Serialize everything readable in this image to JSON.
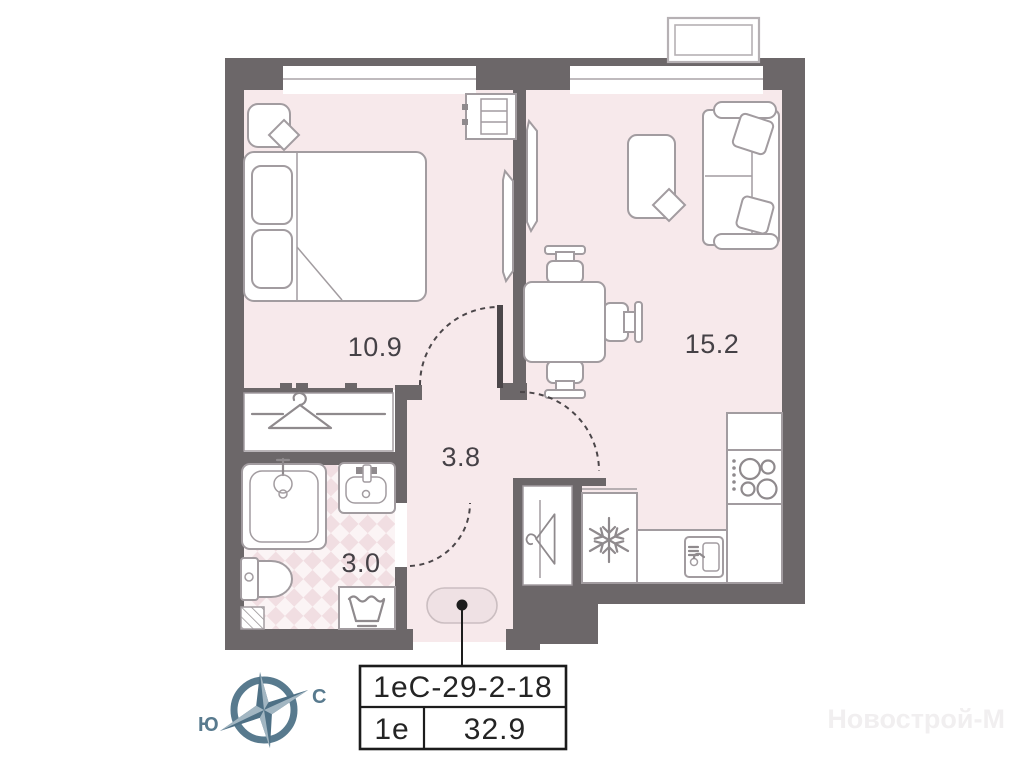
{
  "plan": {
    "rooms": {
      "bedroom": {
        "name": "bedroom",
        "area_label": "10.9"
      },
      "living": {
        "name": "living-kitchen",
        "area_label": "15.2"
      },
      "hall": {
        "name": "hallway",
        "area_label": "3.8"
      },
      "bathroom": {
        "name": "bathroom",
        "area_label": "3.0"
      }
    },
    "compass": {
      "north": "С",
      "south": "Ю"
    },
    "info_table": {
      "unit_code": "1еС-29-2-18",
      "layout_type": "1е",
      "total_area": "32.9"
    },
    "watermark": "Новострой-М"
  },
  "icons": {
    "compass-icon": "four-point star in ring",
    "hanger-icon": "clothes hanger ⧍",
    "snowflake-icon": "❄ fridge",
    "stove-icon": "4 burner circles",
    "kitchen-sink-icon": "basin with faucet",
    "bath-sink-icon": "washbasin",
    "shower-icon": "square tray with mixer",
    "toilet-icon": "tank + bowl",
    "washing-machine-icon": "laundry tub",
    "lamp-icon": "rotated square on nightstand",
    "vent-shaft-icon": "diagonal hatch square",
    "entry-door-marker": "pill with dot"
  },
  "colors": {
    "wall": "#6c6769",
    "floor": "#f7e9eb",
    "checker_light": "#fbf4f5",
    "checker_dark": "#f1dee2",
    "furniture_line": "#a29ca0",
    "icon_line": "#8f8a8d",
    "door_dash": "#4b4649",
    "label_text": "#454146",
    "table_border": "#1c1c1c",
    "compass": "#587a8e",
    "compass_light": "#a2b6c2",
    "compass_dark": "#4e7085",
    "entry_pill_fill": "#efe1e4",
    "entry_pill_stroke": "#cbbec1",
    "window_line": "#aaa4a7",
    "balcony_stroke": "#b6b1b4",
    "watermark_color": "#f1eff0"
  }
}
